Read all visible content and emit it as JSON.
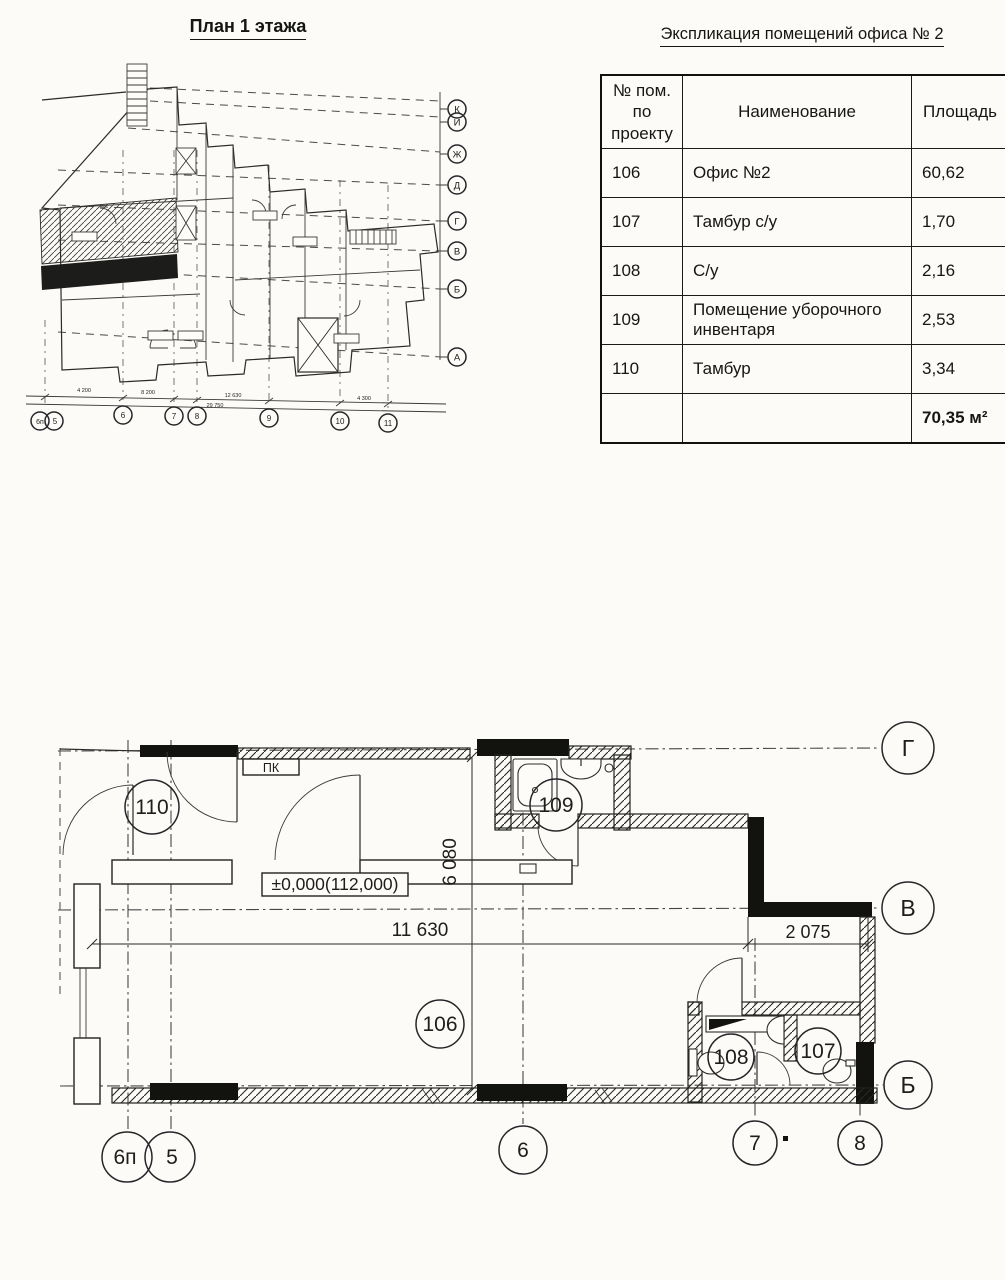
{
  "floor_plan_small": {
    "title": "План 1 этажа",
    "right_axis_labels": [
      "К",
      "И",
      "Ж",
      "Д",
      "Г",
      "В",
      "Б",
      "А"
    ],
    "bottom_axis_labels": [
      "6п",
      "5",
      "6",
      "7",
      "8",
      "9",
      "10",
      "11"
    ],
    "bottom_dims": [
      "4 200",
      "8 200",
      "12 630",
      "4 300"
    ],
    "bottom_total_dim": "29 750"
  },
  "explication_table": {
    "title": "Экспликация помещений офиса № 2",
    "columns": [
      "№ пом. по проекту",
      "Наименование",
      "Площадь"
    ],
    "rows": [
      {
        "num": "106",
        "name": "Офис №2",
        "area": "60,62"
      },
      {
        "num": "107",
        "name": "Тамбур с/у",
        "area": "1,70"
      },
      {
        "num": "108",
        "name": "С/у",
        "area": "2,16"
      },
      {
        "num": "109",
        "name": "Помещение уборочного инвентаря",
        "area": "2,53"
      },
      {
        "num": "110",
        "name": "Тамбур",
        "area": "3,34"
      }
    ],
    "total_area": "70,35 м²"
  },
  "floor_plan_large": {
    "elevation_mark": "±0,000(112,000)",
    "pk_label": "ПК",
    "rooms": [
      {
        "label": "110"
      },
      {
        "label": "109"
      },
      {
        "label": "106"
      },
      {
        "label": "108"
      },
      {
        "label": "107"
      }
    ],
    "dims": {
      "width_main": "11 630",
      "width_right": "2 075",
      "height_main": "6 080"
    },
    "axis_letters": [
      "Г",
      "В",
      "Б"
    ],
    "axis_numbers": [
      "6п",
      "5",
      "6",
      "7",
      "8"
    ]
  }
}
